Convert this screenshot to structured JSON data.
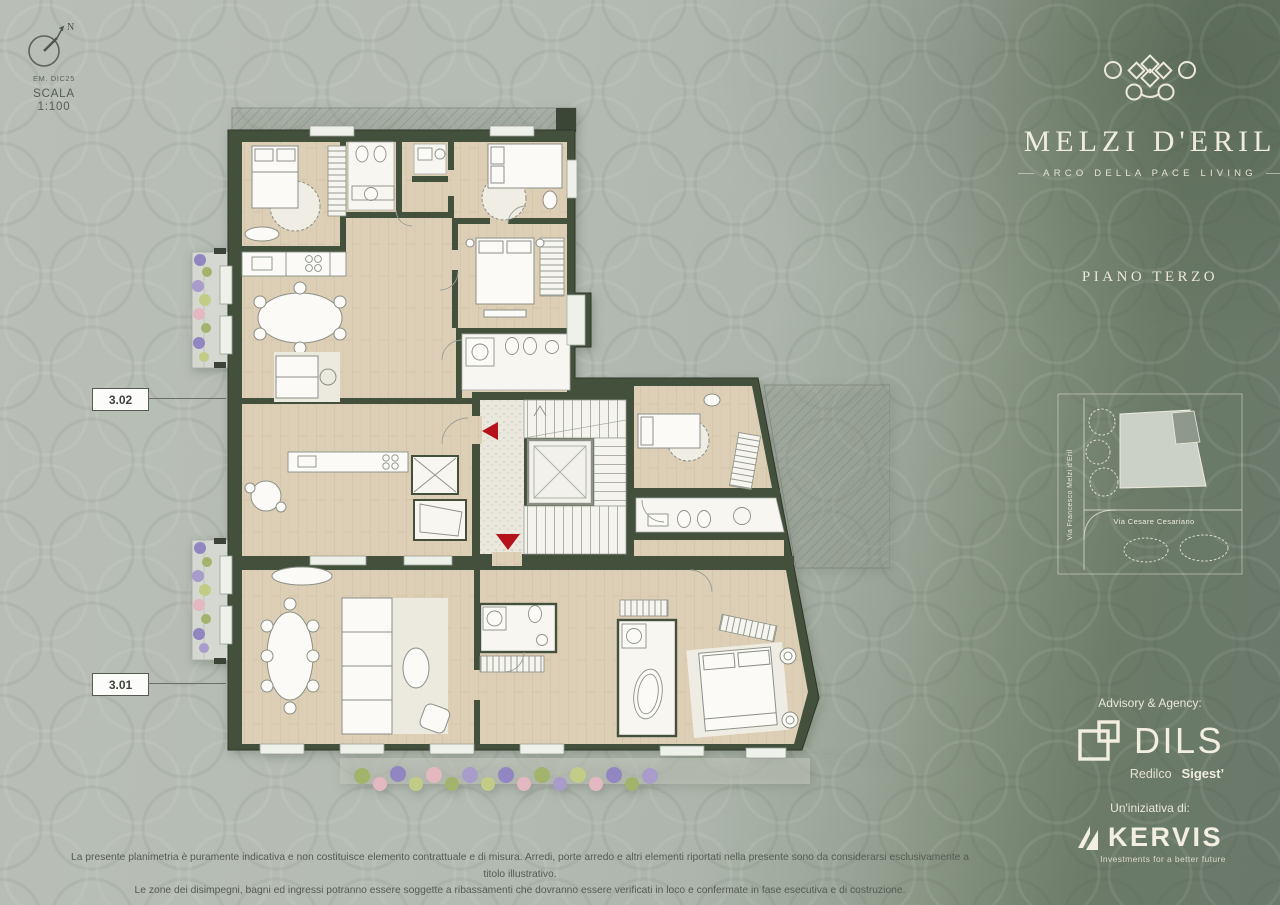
{
  "compass": {
    "north": "N",
    "emission": "EM. DIC25"
  },
  "scale": {
    "label": "SCALA",
    "ratio": "1:100"
  },
  "plan": {
    "unit_top_label": "3.02",
    "unit_bottom_label": "3.01"
  },
  "brand": {
    "name": "MELZI D'ERIL",
    "tagline": "ARCO DELLA PACE LIVING"
  },
  "floor": {
    "label": "PIANO TERZO"
  },
  "site_map": {
    "street_vertical": "Via Francesco Melzi d'Eril",
    "street_horizontal": "Via Cesare Cesariano"
  },
  "advisory": {
    "heading": "Advisory & Agency:",
    "brand": "DILS",
    "sub_brand_1": "Redilco",
    "sub_brand_2": "Sigest’"
  },
  "initiative": {
    "heading": "Un'iniziativa di:",
    "brand": "KERVIS",
    "tagline": "Investments for a better future"
  },
  "disclaimer": {
    "line1": "La presente planimetria è puramente indicativa e non costituisce elemento contrattuale e di misura. Arredi, porte arredo e altri elementi riportati nella presente sono da considerarsi esclusivamente a titolo illustrativo.",
    "line2": "Le zone dei disimpegni, bagni ed ingressi potranno essere soggette a ribassamenti che dovranno essere verificati in loco e confermate in fase esecutiva e di costruzione."
  },
  "colors": {
    "wall_green": "#42503c",
    "floor_wood": "#decfb8",
    "accent_red": "#b5121b",
    "background_light": "#b4bbb3",
    "panel_green": "#6a7967",
    "text_cream": "#ece8da"
  }
}
